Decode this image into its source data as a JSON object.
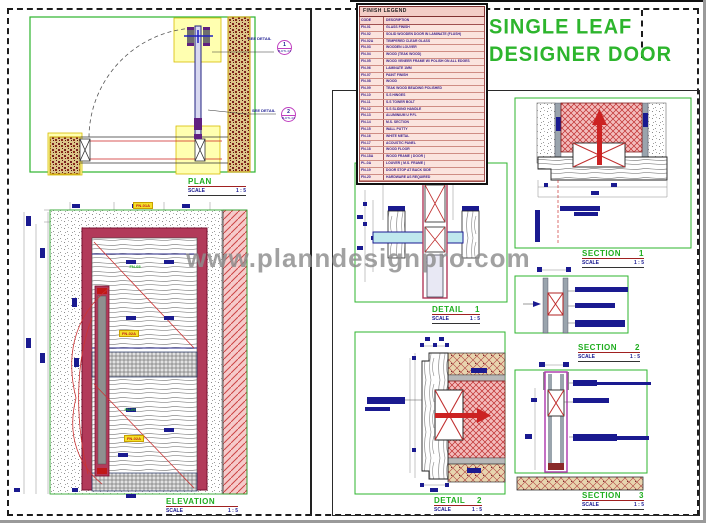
{
  "page": {
    "watermark": "www.planndesignpro.com"
  },
  "title": {
    "line1": "SINGLE LEAF",
    "line2": "DESIGNER DOOR"
  },
  "legend": {
    "title": "FINISH LEGEND",
    "col_code": "CODE",
    "col_desc": "DESCRIPTION",
    "rows": [
      {
        "code": "FN-01",
        "desc": "GLASS FINISH"
      },
      {
        "code": "FN-02",
        "desc": "SOLID WOODEN DOOR IN LAMINATE (FLUSH)"
      },
      {
        "code": "FN-02A",
        "desc": "TEMPERED CLEAR GLASS"
      },
      {
        "code": "FN-03",
        "desc": "WOODEN LOUVER"
      },
      {
        "code": "FN-04",
        "desc": "WOOD (TEAK WOOD)"
      },
      {
        "code": "FN-05",
        "desc": "WOOD VENEER FRAME W/ POLISH ON ALL EDGES"
      },
      {
        "code": "FN-06",
        "desc": "LAMINATE 1MM"
      },
      {
        "code": "FN-07",
        "desc": "PAINT FINISH"
      },
      {
        "code": "FN-08",
        "desc": "WOOD"
      },
      {
        "code": "FN-09",
        "desc": "TEAK WOOD BEADING POLISHED"
      },
      {
        "code": "FN-10",
        "desc": "S.S HINGES"
      },
      {
        "code": "FN-11",
        "desc": "S.S TOWER BOLT"
      },
      {
        "code": "FN-12",
        "desc": "S.S SLIDING HANDLE"
      },
      {
        "code": "FN-13",
        "desc": "ALUMINIUM U P.FL"
      },
      {
        "code": "FN-14",
        "desc": "M.S. SECTION"
      },
      {
        "code": "FN-15",
        "desc": "WALL PUTTY"
      },
      {
        "code": "FN-16",
        "desc": "WHITE METAL"
      },
      {
        "code": "FN-17",
        "desc": "ACOUSTIC PANEL"
      },
      {
        "code": "FN-18",
        "desc": "WOOD FLOOR"
      },
      {
        "code": "FN-18A",
        "desc": "WOOD FRAME ( DOOR )"
      },
      {
        "code": "PL-0A",
        "desc": "LOUVER ( M.S. FRAME )"
      },
      {
        "code": "FN-19",
        "desc": "DOOR STOP AT BACK SIDE"
      },
      {
        "code": "FN-20",
        "desc": "HARDWARE AS REQUIRED"
      }
    ]
  },
  "views": {
    "plan": {
      "name": "PLAN",
      "scale_label": "SCALE",
      "scale": "1 : 5"
    },
    "elevation": {
      "name": "ELEVATION",
      "scale_label": "SCALE",
      "scale": "1 : 5"
    },
    "detail1": {
      "name": "DETAIL",
      "num": "1",
      "scale_label": "SCALE",
      "scale": "1 : 5"
    },
    "detail2": {
      "name": "DETAIL",
      "num": "2",
      "scale_label": "SCALE",
      "scale": "1 : 5"
    },
    "section1": {
      "name": "SECTION",
      "num": "1",
      "scale_label": "SCALE",
      "scale": "1 : 5"
    },
    "section2": {
      "name": "SECTION",
      "num": "2",
      "scale_label": "SCALE",
      "scale": "1 : 5"
    },
    "section3": {
      "name": "SECTION",
      "num": "3",
      "scale_label": "SCALE",
      "scale": "1 : 5"
    }
  },
  "plan_callouts": {
    "see_detail_1": "SEE DETAIL",
    "see_detail_2": "SEE DETAIL",
    "c1": "1",
    "c1_sub": "B-DTL.01",
    "c2": "2",
    "c2_sub": "B-DTL.01"
  },
  "tags": {
    "t1": "FN-01A",
    "t2": "FN-02A",
    "t3": "FN-02A",
    "g1": "FN-05",
    "g2": "FN-09"
  }
}
